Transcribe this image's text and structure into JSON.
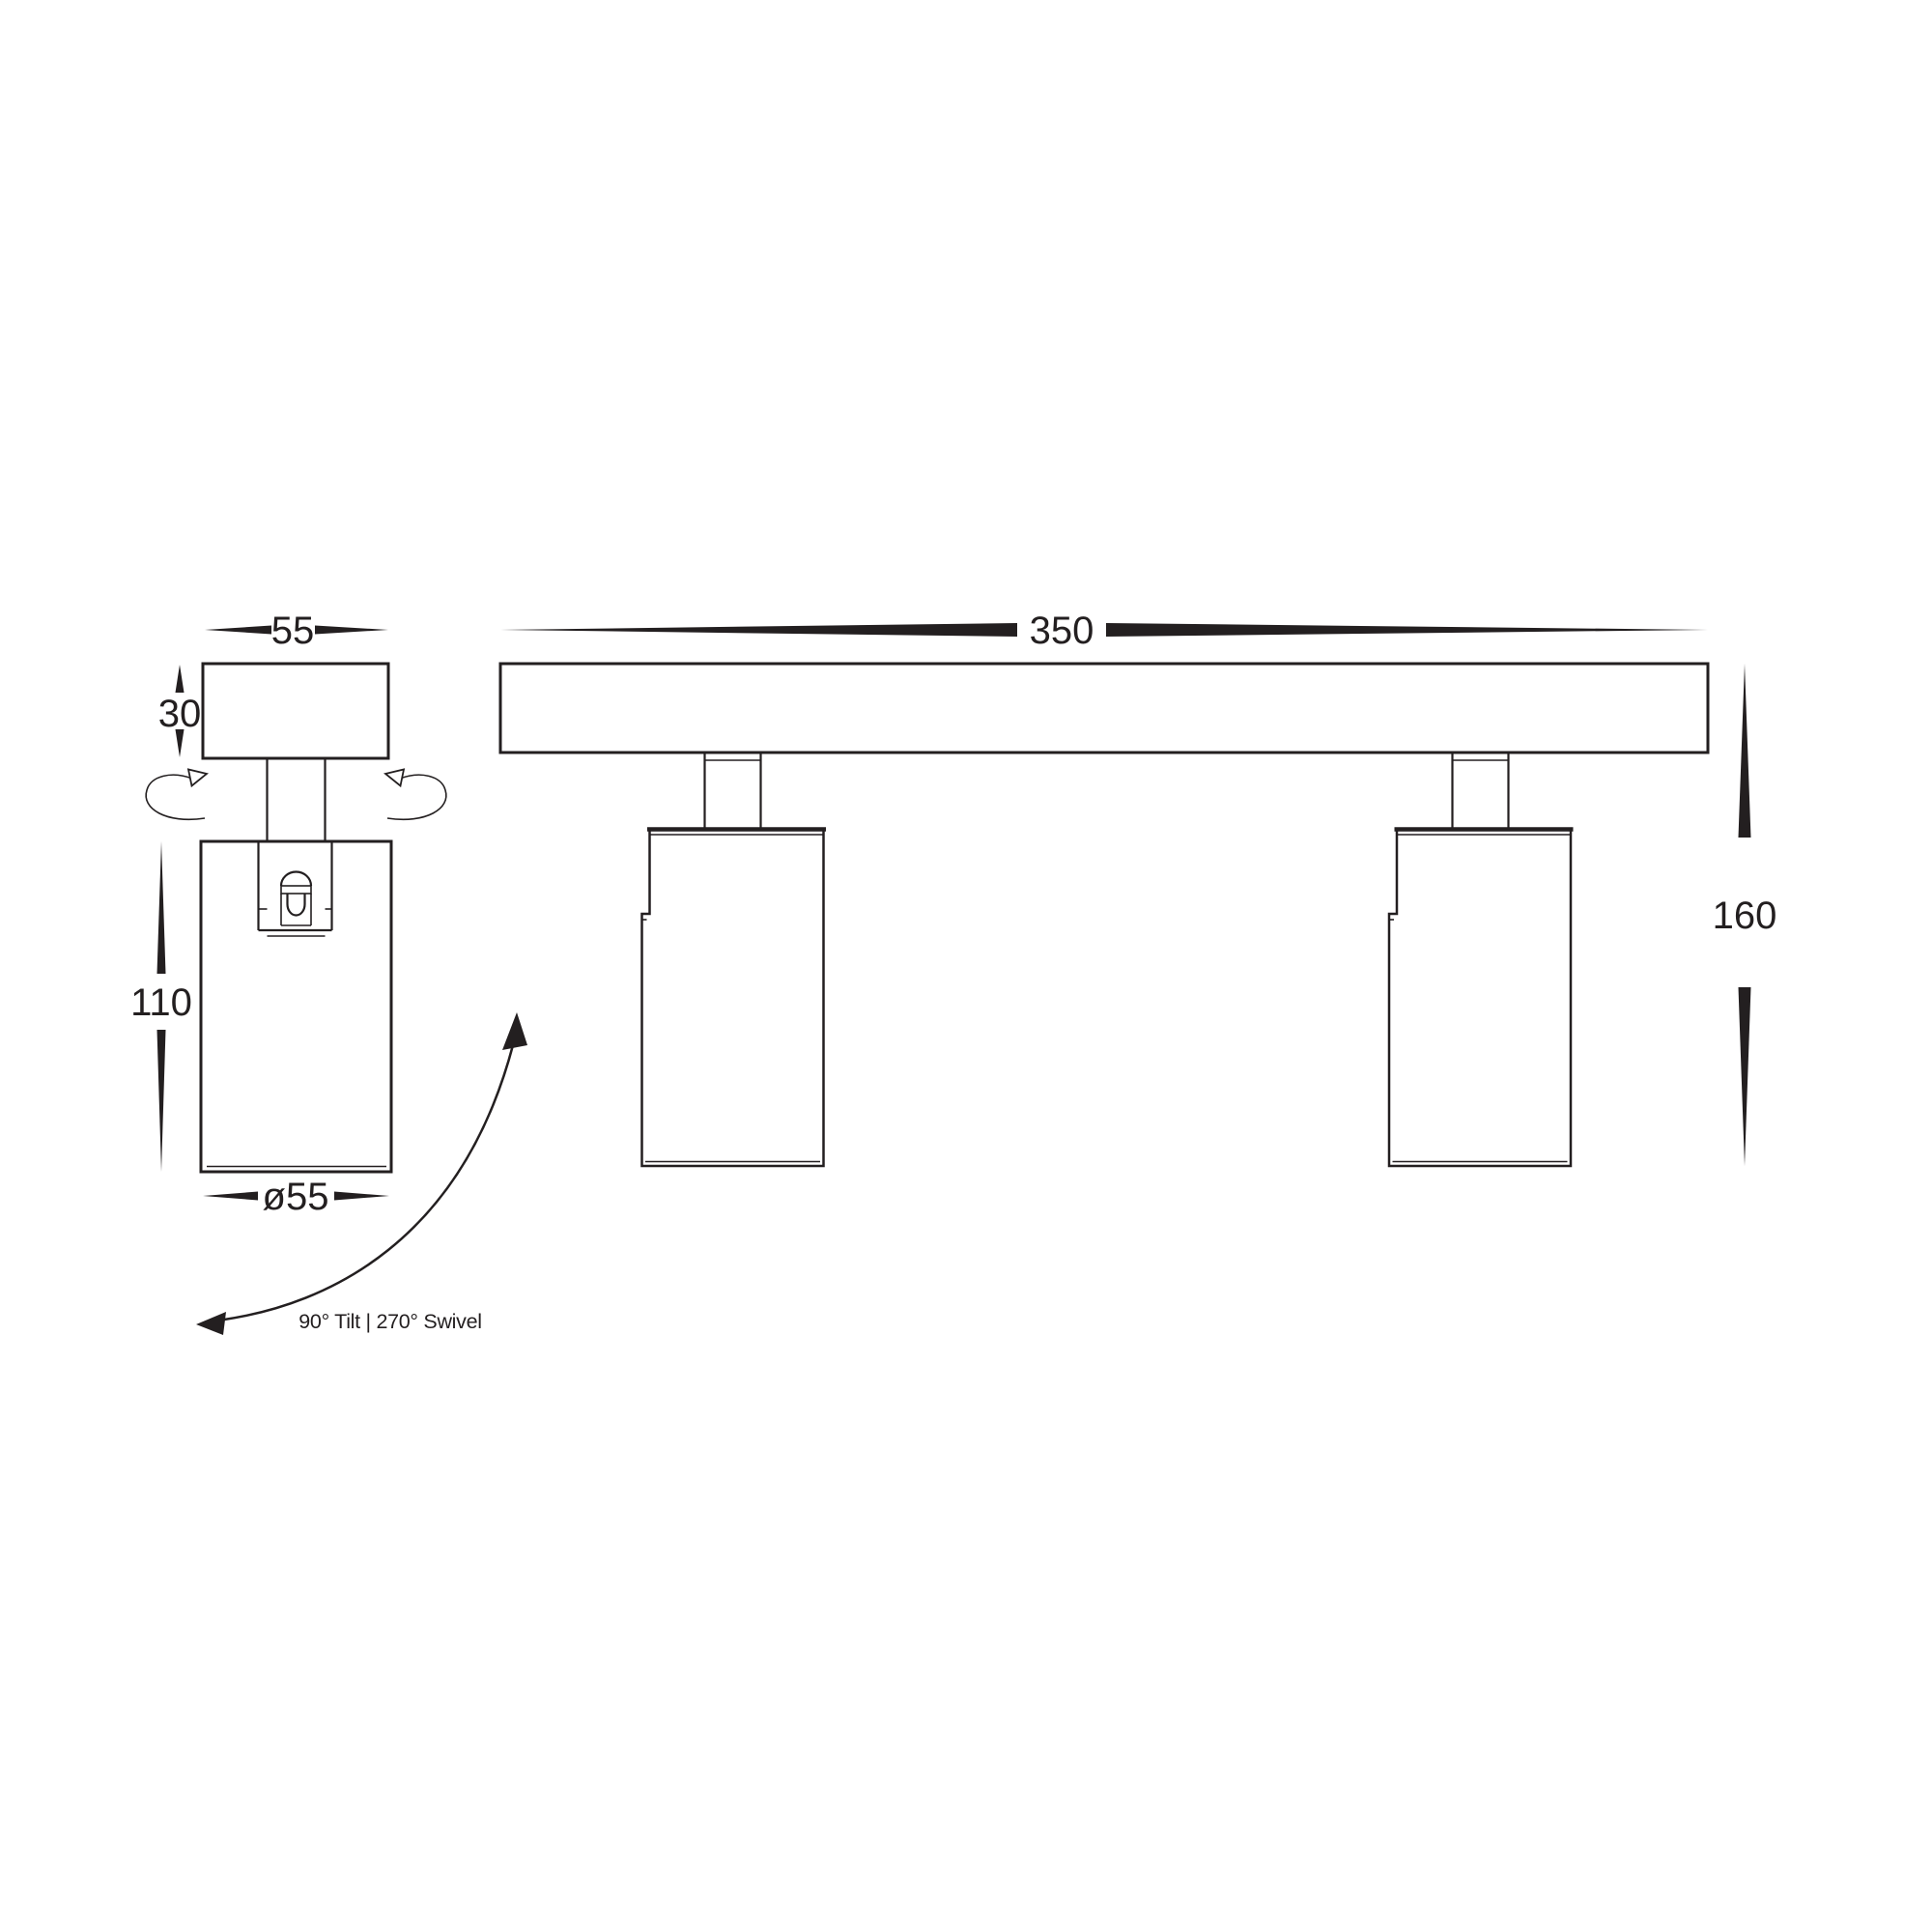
{
  "drawing": {
    "colors": {
      "line": "#231f20",
      "background": "#ffffff"
    },
    "dimensions": {
      "canopy_width": "55",
      "canopy_height": "30",
      "body_height": "110",
      "body_diameter": "ø55",
      "bar_length": "350",
      "overall_height": "160"
    },
    "annotations": {
      "adjustability": "90° Tilt | 270° Swivel"
    }
  }
}
